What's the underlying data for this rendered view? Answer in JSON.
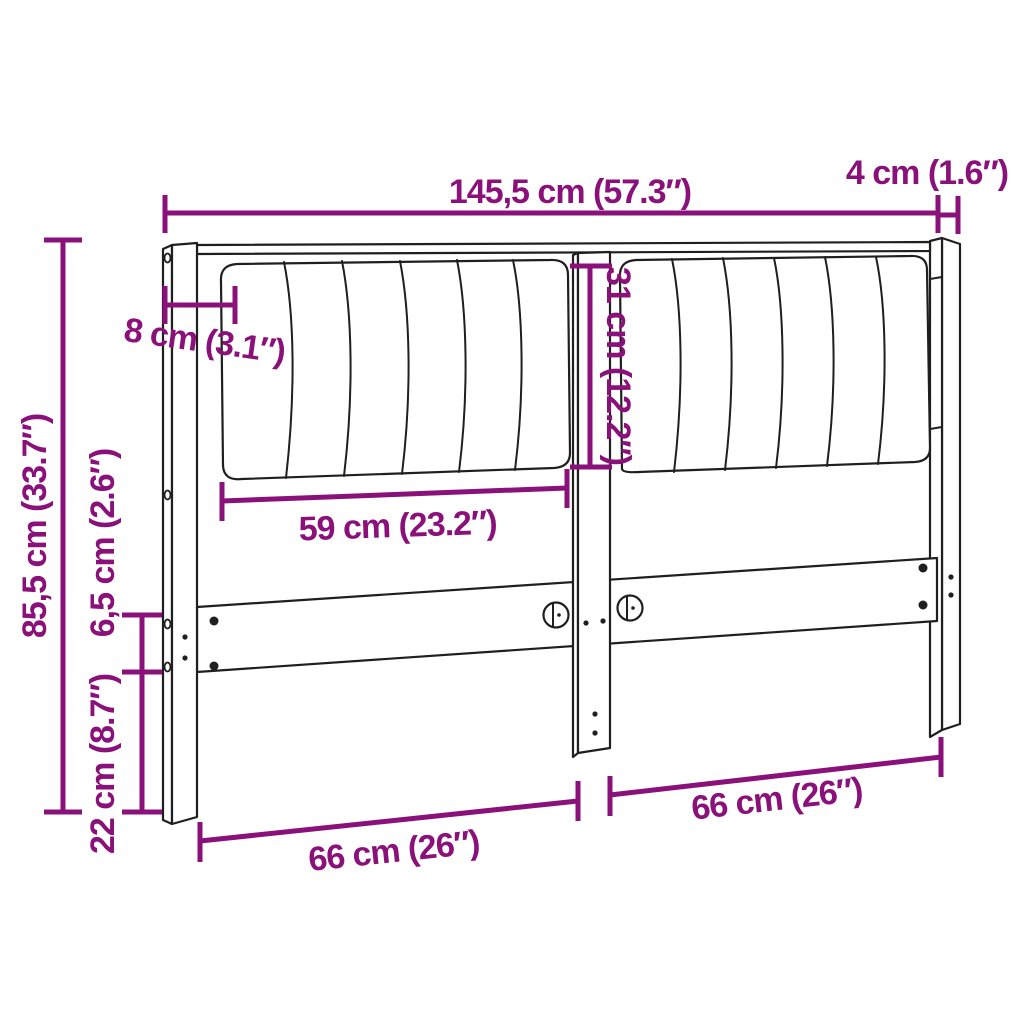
{
  "colors": {
    "accent": "#8B117A",
    "line_art": "#1f1f1f",
    "background": "#ffffff"
  },
  "dimensions": {
    "total_width": {
      "label": "145,5 cm (57.3″)",
      "cm": "145,5",
      "inches": "57.3"
    },
    "post_width": {
      "label": "4 cm (1.6″)",
      "cm": "4",
      "inches": "1.6"
    },
    "total_height": {
      "label": "85,5 cm (33.7″)",
      "cm": "85,5",
      "inches": "33.7"
    },
    "cushion_inset": {
      "label": "8 cm (3.1″)",
      "cm": "8",
      "inches": "3.1"
    },
    "cushion_height": {
      "label": "31 cm (12.2″)",
      "cm": "31",
      "inches": "12.2"
    },
    "cushion_width": {
      "label": "59 cm (23.2″)",
      "cm": "59",
      "inches": "23.2"
    },
    "rail_height": {
      "label": "6,5 cm (2.6″)",
      "cm": "6,5",
      "inches": "2.6"
    },
    "lower_height": {
      "label": "22 cm (8.7″)",
      "cm": "22",
      "inches": "8.7"
    },
    "leg_span_left": {
      "label": "66 cm (26″)",
      "cm": "66",
      "inches": "26"
    },
    "leg_span_right": {
      "label": "66 cm (26″)",
      "cm": "66",
      "inches": "26"
    }
  }
}
